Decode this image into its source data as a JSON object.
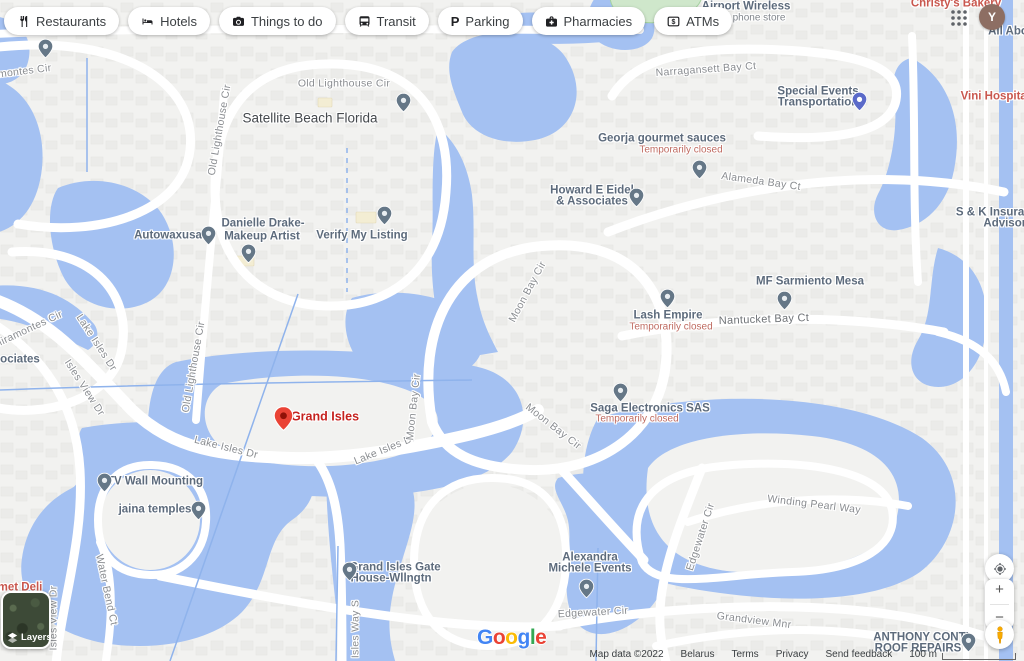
{
  "header": {
    "chips": [
      {
        "label": "Restaurants",
        "icon": "restaurants-icon"
      },
      {
        "label": "Hotels",
        "icon": "hotels-icon"
      },
      {
        "label": "Things to do",
        "icon": "things-to-do-icon"
      },
      {
        "label": "Transit",
        "icon": "transit-icon"
      },
      {
        "label": "Parking",
        "icon": "parking-icon"
      },
      {
        "label": "Pharmacies",
        "icon": "pharmacies-icon"
      },
      {
        "label": "ATMs",
        "icon": "atms-icon"
      }
    ],
    "avatar_letter": "Y"
  },
  "map": {
    "water_color": "#a4c1f2",
    "pin_colors": {
      "gray": {
        "fill": "#657787",
        "dot": "#e9eef2"
      },
      "red": {
        "fill": "#ea4335",
        "dot": "#901107"
      },
      "purple": {
        "fill": "#5b6ac9",
        "dot": "#ffffff"
      }
    },
    "labels": [
      {
        "name": "road-label-miramontes-top",
        "text": "Miramontes Cir",
        "x": 14,
        "y": 73,
        "rot": -7,
        "kind": "road"
      },
      {
        "name": "road-label-old-lighthouse-top",
        "text": "Old Lighthouse Cir",
        "x": 344,
        "y": 84,
        "rot": 0,
        "kind": "road"
      },
      {
        "name": "locality-label-satellite-beach",
        "text": "Satellite Beach Florida",
        "x": 310,
        "y": 118,
        "rot": 0,
        "kind": "locality"
      },
      {
        "name": "poi-label-airport-wireless",
        "text": "Airport Wireless",
        "x": 746,
        "y": 7,
        "rot": 0,
        "kind": "poi"
      },
      {
        "name": "poi-sublabel-cell-phone-store",
        "text": "Cell phone store",
        "x": 749,
        "y": 18,
        "rot": 0,
        "kind": "poi-sub"
      },
      {
        "name": "poi-label-christys-bakery",
        "text": "Christy's Bakery",
        "x": 956,
        "y": 4,
        "rot": 0,
        "kind": "food"
      },
      {
        "name": "road-label-narragansett",
        "text": "Narragansett Bay Ct",
        "x": 706,
        "y": 70,
        "rot": -4,
        "kind": "road"
      },
      {
        "name": "poi-label-special-events-1",
        "text": "Special Events",
        "x": 818,
        "y": 92,
        "rot": 0,
        "kind": "poi"
      },
      {
        "name": "poi-label-special-events-2",
        "text": "Transportation",
        "x": 818,
        "y": 103,
        "rot": 0,
        "kind": "poi"
      },
      {
        "name": "poi-label-vini-hospitality",
        "text": "Vini Hospitality",
        "x": 1002,
        "y": 97,
        "rot": 0,
        "kind": "food"
      },
      {
        "name": "poi-label-georja",
        "text": "Georja gourmet sauces",
        "x": 662,
        "y": 139,
        "rot": 0,
        "kind": "poi"
      },
      {
        "name": "status-label-georja-closed",
        "text": "Temporarily closed",
        "x": 681,
        "y": 150,
        "rot": 0,
        "kind": "closed"
      },
      {
        "name": "road-label-alameda",
        "text": "Alameda Bay Ct",
        "x": 761,
        "y": 182,
        "rot": 8,
        "kind": "road"
      },
      {
        "name": "poi-label-howard-1",
        "text": "Howard E Eidel",
        "x": 592,
        "y": 191,
        "rot": 0,
        "kind": "poi"
      },
      {
        "name": "poi-label-howard-2",
        "text": "& Associates",
        "x": 592,
        "y": 202,
        "rot": 0,
        "kind": "poi"
      },
      {
        "name": "poi-label-sk-insurance-1",
        "text": "S & K Insurance",
        "x": 1000,
        "y": 213,
        "rot": 0,
        "kind": "poi"
      },
      {
        "name": "poi-label-sk-insurance-2",
        "text": "Advisors",
        "x": 1008,
        "y": 224,
        "rot": 0,
        "kind": "poi"
      },
      {
        "name": "poi-label-autowaxusa",
        "text": "Autowaxusa",
        "x": 168,
        "y": 236,
        "rot": 0,
        "kind": "poi"
      },
      {
        "name": "poi-label-danielle-1",
        "text": "Danielle Drake-",
        "x": 263,
        "y": 224,
        "rot": 0,
        "kind": "poi"
      },
      {
        "name": "poi-label-danielle-2",
        "text": "Makeup Artist",
        "x": 262,
        "y": 237,
        "rot": 0,
        "kind": "poi"
      },
      {
        "name": "poi-label-verify-listing",
        "text": "Verify My Listing",
        "x": 362,
        "y": 236,
        "rot": 0,
        "kind": "poi"
      },
      {
        "name": "road-label-old-lighthouse-v1",
        "text": "Old Lighthouse Cir",
        "x": 220,
        "y": 130,
        "rot": -80,
        "kind": "road"
      },
      {
        "name": "road-label-old-lighthouse-v2",
        "text": "Old Lighthouse Cir",
        "x": 194,
        "y": 367,
        "rot": -80,
        "kind": "road"
      },
      {
        "name": "road-label-miramontes-2",
        "text": "Miramontes Cir",
        "x": 28,
        "y": 330,
        "rot": -25,
        "kind": "road"
      },
      {
        "name": "poi-label-ociates",
        "text": "ociates",
        "x": 20,
        "y": 360,
        "rot": 0,
        "kind": "poi"
      },
      {
        "name": "road-label-lake-isles-1",
        "text": "Lake Isles Dr",
        "x": 96,
        "y": 343,
        "rot": 57,
        "kind": "road"
      },
      {
        "name": "road-label-isles-view-1",
        "text": "Isles View Dr",
        "x": 84,
        "y": 388,
        "rot": 57,
        "kind": "road"
      },
      {
        "name": "dest-label-grand-isles",
        "text": "Grand Isles",
        "x": 325,
        "y": 417,
        "rot": 0,
        "kind": "dest"
      },
      {
        "name": "road-label-lake-isles-2",
        "text": "Lake Isles Dr",
        "x": 226,
        "y": 448,
        "rot": 14,
        "kind": "road"
      },
      {
        "name": "road-label-lake-isles-3",
        "text": "Lake Isles Dr",
        "x": 385,
        "y": 450,
        "rot": -22,
        "kind": "road"
      },
      {
        "name": "road-label-moon-bay-1",
        "text": "Moon Bay Cir",
        "x": 414,
        "y": 407,
        "rot": -84,
        "kind": "road"
      },
      {
        "name": "road-label-moon-bay-2",
        "text": "Moon Bay Cir",
        "x": 528,
        "y": 292,
        "rot": -62,
        "kind": "road"
      },
      {
        "name": "road-label-moon-bay-3",
        "text": "Moon Bay Cir",
        "x": 553,
        "y": 427,
        "rot": 38,
        "kind": "road"
      },
      {
        "name": "poi-label-lash-empire",
        "text": "Lash Empire",
        "x": 668,
        "y": 316,
        "rot": 0,
        "kind": "poi"
      },
      {
        "name": "status-label-lash-closed",
        "text": "Temporarily closed",
        "x": 671,
        "y": 327,
        "rot": 0,
        "kind": "closed"
      },
      {
        "name": "poi-label-mf-sarmiento",
        "text": "MF Sarmiento Mesa",
        "x": 810,
        "y": 282,
        "rot": 0,
        "kind": "poi"
      },
      {
        "name": "road-label-nantucket",
        "text": "Nantucket Bay Ct",
        "x": 764,
        "y": 320,
        "rot": -2,
        "kind": "road-dark"
      },
      {
        "name": "poi-label-saga",
        "text": "Saga Electronics SAS",
        "x": 650,
        "y": 409,
        "rot": 0,
        "kind": "poi"
      },
      {
        "name": "status-label-saga-closed",
        "text": "Temporarily closed",
        "x": 637,
        "y": 419,
        "rot": 0,
        "kind": "closed"
      },
      {
        "name": "poi-label-tv-wall",
        "text": "TV Wall Mounting",
        "x": 155,
        "y": 482,
        "rot": 0,
        "kind": "poi"
      },
      {
        "name": "poi-label-jaina",
        "text": "jaina temples",
        "x": 155,
        "y": 510,
        "rot": 0,
        "kind": "poi"
      },
      {
        "name": "road-label-winding-pearl",
        "text": "Winding Pearl Way",
        "x": 814,
        "y": 505,
        "rot": 7,
        "kind": "road"
      },
      {
        "name": "road-label-edgewater-v",
        "text": "Edgewater Cir",
        "x": 701,
        "y": 537,
        "rot": -72,
        "kind": "road"
      },
      {
        "name": "poi-label-alexandra-1",
        "text": "Alexandra",
        "x": 590,
        "y": 558,
        "rot": 0,
        "kind": "poi"
      },
      {
        "name": "poi-label-alexandra-2",
        "text": "Michele Events",
        "x": 590,
        "y": 569,
        "rot": 0,
        "kind": "poi"
      },
      {
        "name": "poi-label-gate-1",
        "text": "Grand Isles Gate",
        "x": 395,
        "y": 568,
        "rot": 0,
        "kind": "poi"
      },
      {
        "name": "poi-label-gate-2",
        "text": "House-Wllngtn",
        "x": 391,
        "y": 579,
        "rot": 0,
        "kind": "poi"
      },
      {
        "name": "road-label-water-bend",
        "text": "Water Bend Ct",
        "x": 106,
        "y": 590,
        "rot": 78,
        "kind": "road"
      },
      {
        "name": "road-label-isles-view-2",
        "text": "Isles View Dr",
        "x": 54,
        "y": 618,
        "rot": -90,
        "kind": "road"
      },
      {
        "name": "road-label-isles-way-s",
        "text": "Isles Way S",
        "x": 356,
        "y": 629,
        "rot": -90,
        "kind": "road"
      },
      {
        "name": "road-label-edgewater-2",
        "text": "Edgewater Cir",
        "x": 593,
        "y": 613,
        "rot": -3,
        "kind": "road"
      },
      {
        "name": "road-label-grandview",
        "text": "Grandview Mnr",
        "x": 754,
        "y": 621,
        "rot": 7,
        "kind": "road"
      },
      {
        "name": "poi-label-anthony-1",
        "text": "ANTHONY CONTI",
        "x": 921,
        "y": 638,
        "rot": 0,
        "kind": "poi"
      },
      {
        "name": "poi-label-anthony-2",
        "text": "ROOF REPAIRS",
        "x": 918,
        "y": 649,
        "rot": 0,
        "kind": "poi"
      },
      {
        "name": "poi-label-met-deli",
        "text": "met Deli",
        "x": 20,
        "y": 588,
        "rot": 0,
        "kind": "food"
      },
      {
        "name": "poi-label-all-abo",
        "text": "All Abo",
        "x": 1008,
        "y": 32,
        "rot": 0,
        "kind": "poi"
      }
    ],
    "pins": [
      {
        "name": "poi-pin-top-left",
        "x": 45,
        "y": 58,
        "kind": "gray"
      },
      {
        "name": "poi-pin-satellite-beach",
        "x": 403,
        "y": 112,
        "kind": "gray"
      },
      {
        "name": "poi-pin-autowaxusa",
        "x": 208,
        "y": 245,
        "kind": "gray"
      },
      {
        "name": "poi-pin-danielle",
        "x": 248,
        "y": 263,
        "kind": "gray"
      },
      {
        "name": "poi-pin-verify-listing",
        "x": 384,
        "y": 225,
        "kind": "gray"
      },
      {
        "name": "poi-pin-georja",
        "x": 699,
        "y": 179,
        "kind": "gray"
      },
      {
        "name": "poi-pin-howard",
        "x": 636,
        "y": 207,
        "kind": "gray"
      },
      {
        "name": "poi-pin-special-events",
        "x": 859,
        "y": 111,
        "kind": "purple"
      },
      {
        "name": "poi-pin-mf-sarmiento",
        "x": 784,
        "y": 310,
        "kind": "gray"
      },
      {
        "name": "poi-pin-lash-empire",
        "x": 667,
        "y": 308,
        "kind": "gray"
      },
      {
        "name": "poi-pin-saga",
        "x": 620,
        "y": 402,
        "kind": "gray"
      },
      {
        "name": "poi-pin-tv-wall",
        "x": 104,
        "y": 492,
        "kind": "gray"
      },
      {
        "name": "poi-pin-jaina",
        "x": 198,
        "y": 520,
        "kind": "gray"
      },
      {
        "name": "poi-pin-alexandra",
        "x": 586,
        "y": 598,
        "kind": "gray"
      },
      {
        "name": "poi-pin-gate",
        "x": 349,
        "y": 581,
        "kind": "gray"
      },
      {
        "name": "poi-pin-anthony",
        "x": 968,
        "y": 652,
        "kind": "gray"
      },
      {
        "name": "destination-pin-grand-isles",
        "x": 283,
        "y": 431,
        "kind": "red"
      }
    ]
  },
  "controls": {
    "zoom_in_label": "+",
    "zoom_out_label": "−",
    "layers_label": "Layers"
  },
  "google_logo": [
    {
      "ch": "G",
      "color": "#4285F4"
    },
    {
      "ch": "o",
      "color": "#EA4335"
    },
    {
      "ch": "o",
      "color": "#FBBC05"
    },
    {
      "ch": "g",
      "color": "#4285F4"
    },
    {
      "ch": "l",
      "color": "#34A853"
    },
    {
      "ch": "e",
      "color": "#EA4335"
    }
  ],
  "attribution": {
    "map_data": "Map data ©2022",
    "region": "Belarus",
    "terms": "Terms",
    "privacy": "Privacy",
    "feedback": "Send feedback",
    "scale": "100 m"
  }
}
